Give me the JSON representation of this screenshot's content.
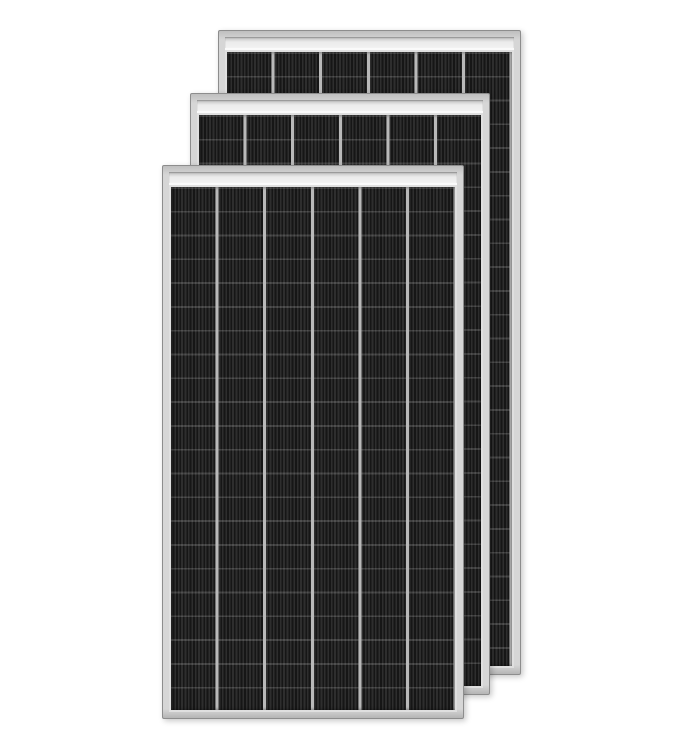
{
  "scene": {
    "description": "Product photo of three framed black half-cut-cell solar panels standing upright, fanned front to back on a white background",
    "background_color": "#ffffff",
    "panel_count": 3
  },
  "panels": [
    {
      "name": "back",
      "left": 218,
      "top": 30,
      "width": 303,
      "height": 645,
      "z": 1
    },
    {
      "name": "middle",
      "left": 190,
      "top": 93,
      "width": 300,
      "height": 602,
      "z": 2
    },
    {
      "name": "front",
      "left": 162,
      "top": 165,
      "width": 302,
      "height": 554,
      "z": 3
    }
  ],
  "panel_style": {
    "columns": 6,
    "column_pitch_px": 47.6,
    "row_pitch_px": 23.8,
    "gutter_width_px": 3,
    "frame_edge_color": "#8d8d8d",
    "frame_face_color": "#d6d6d6",
    "rail_face_color": "#ebebeb",
    "inner_trim_color": "#fafafa",
    "cell_base_color": "#1d1d1d",
    "stripe_light_color": "#2e2e2e",
    "stripe_dark_color": "#161616",
    "rowline_color": "rgba(255,255,255,0.16)",
    "gutter_color": "#b9b9b9",
    "divider_color": "#ffffff"
  }
}
